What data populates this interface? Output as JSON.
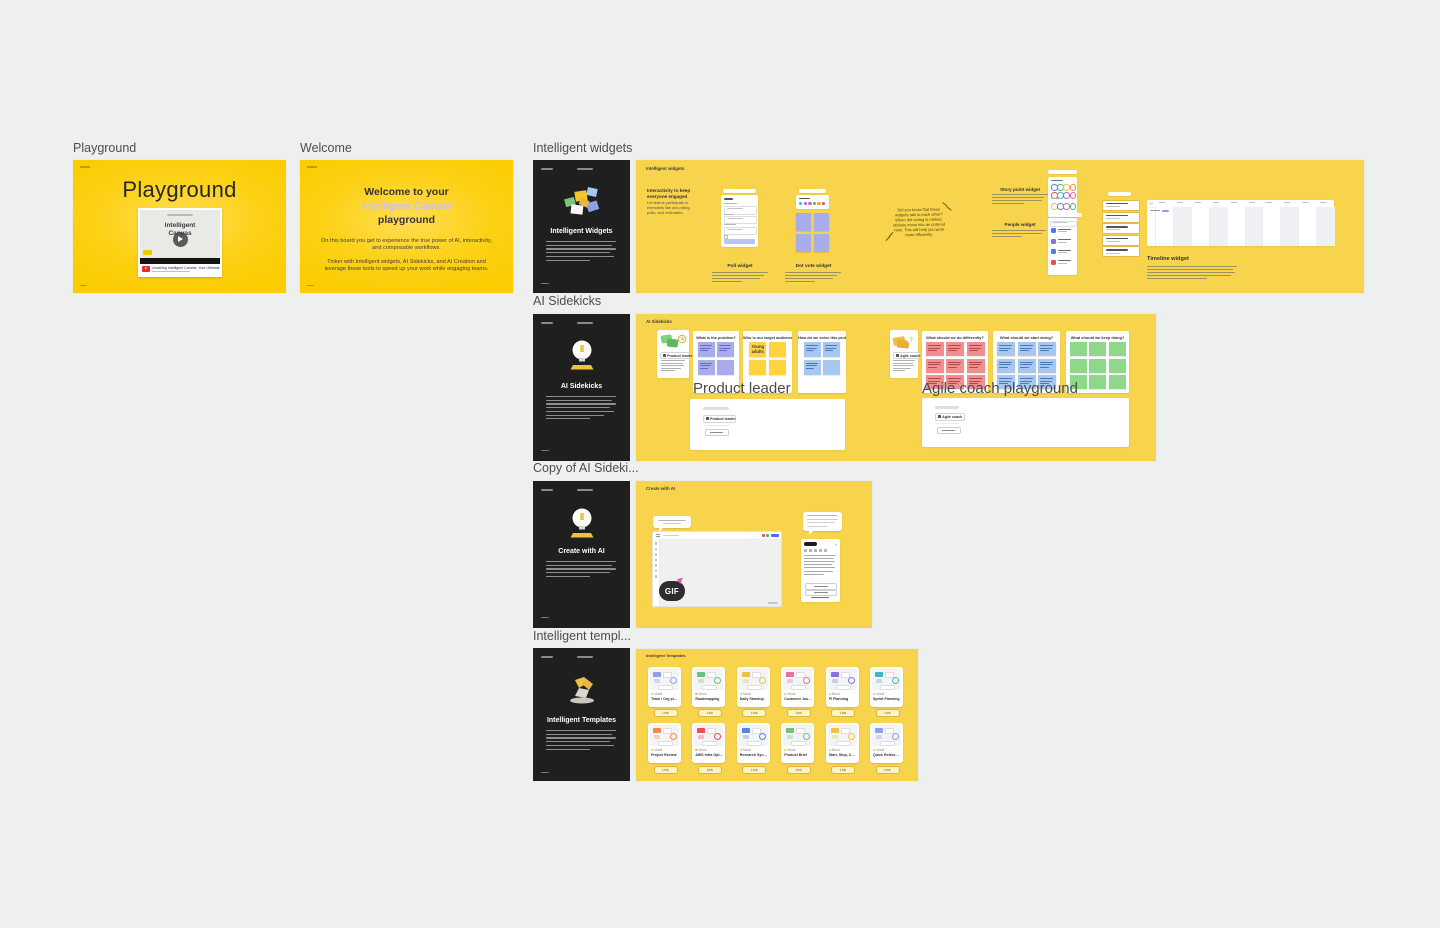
{
  "ui": {
    "background": "#edf0ef",
    "frame_yellow": "#fbcc00",
    "frame_soft_yellow": "#f8d44c",
    "dark_card_bg": "#1f1f1f",
    "poll_button_blue": "#b9c4f0",
    "sticky_purple": "#a9aceb",
    "sticky_yellow": "#ffd43e",
    "sticky_blue": "#a6c8f0",
    "sticky_red": "#ef8f8f",
    "sticky_green": "#8fd88a"
  },
  "section_labels": {
    "playground": "Playground",
    "welcome": "Welcome",
    "widgets": "Intelligent widgets",
    "sidekicks": "AI Sidekicks",
    "copy_sidekicks": "Copy of AI Sideki...",
    "templates": "Intelligent templ..."
  },
  "playground_frame": {
    "title": "Playground",
    "video_title_line1": "Intelligent",
    "video_title_line2": "Canvas",
    "video_caption": "Unveiling Intelligent Canvas: Your Ultimate Pow..."
  },
  "welcome_frame": {
    "heading_line1": "Welcome to your",
    "heading_line2": "Intelligent Canvas",
    "heading_line3": "playground",
    "para1": "On this board you get to experience the true power of AI, interactivity, and composable workflows.",
    "para2": "Tinker with Intelligent widgets, AI Sidekicks, and AI Creation and leverage these tools to speed up your work while engaging teams."
  },
  "widgets_dark_card": {
    "title": "Intelligent Widgets"
  },
  "sidekicks_dark_card": {
    "title": "AI Sidekicks"
  },
  "create_dark_card": {
    "title": "Create with AI"
  },
  "templates_dark_card": {
    "title": "Intelligent Templates"
  },
  "widgets_frame": {
    "label": "Intelligent widgets",
    "headline": "Interactivity to keep everyone engaged",
    "body": "Let teams participate in exercises like dot voting, polls, and estimates.",
    "poll_label": "Poll widget",
    "dot_vote_label": "Dot vote widget",
    "note": "Did you know that these widgets talk to each other? When dot voting is ranked, stickies move into an ordered rank. This will help you work more efficiently.",
    "story_point_label": "Story point widget",
    "people_label": "People widget",
    "timeline_label": "Timeline widget",
    "dot_colors": [
      "#45b5c4",
      "#8f6fd8",
      "#e8609e",
      "#58b85c",
      "#f0a43c",
      "#e05252"
    ],
    "story_dot_rows": [
      [
        "#4f86e8",
        "#4fb86a",
        "#f0c040",
        "#f08a3c"
      ],
      [
        "#e05252",
        "#45b5c4",
        "#8f6fd8",
        "#e8609e"
      ],
      [
        "#f0c040",
        "#4f86e8",
        "#e8609e",
        "#4fb86a"
      ]
    ],
    "people_avatar_colors": [
      "#4a7fd4",
      "#8f6fd8",
      "#4a7fd4",
      "#e05252"
    ]
  },
  "sidekicks_frame": {
    "label": "AI Sidekicks",
    "product_leader_tag": "Product leader",
    "agile_coach_tag": "Agile coach",
    "overlay_product": "Product leader",
    "overlay_agile": "Agile coach playground",
    "panels": [
      {
        "question": "What is the problem?",
        "color": "#a9aceb",
        "line_color": "#646ac8",
        "cols": 2,
        "rows": 2,
        "cells": [
          "lines",
          "lines",
          "lines",
          "blank"
        ]
      },
      {
        "question": "Who is our target audience",
        "color": "#ffd43e",
        "line_color": "#b08a10",
        "cols": 2,
        "rows": 2,
        "cells": [
          "text:Young adults",
          "blank",
          "blank",
          "blank"
        ]
      },
      {
        "question": "How do we solve this problem?",
        "color": "#a6c8f0",
        "line_color": "#4a7ab8",
        "cols": 2,
        "rows": 2,
        "cells": [
          "lines",
          "lines",
          "lines",
          "blank"
        ]
      },
      {
        "question": "What should we do differently?",
        "color": "#ef8f8f",
        "line_color": "#b84848",
        "cols": 3,
        "rows": 3,
        "cells": [
          "lines",
          "lines",
          "lines",
          "lines",
          "lines",
          "lines",
          "lines",
          "lines",
          "lines"
        ]
      },
      {
        "question": "What should we start doing?",
        "color": "#a6c8f0",
        "line_color": "#4a7ab8",
        "cols": 3,
        "rows": 3,
        "cells": [
          "lines",
          "lines",
          "lines",
          "lines",
          "lines",
          "lines",
          "lines",
          "lines",
          "lines"
        ]
      },
      {
        "question": "What should we keep doing?",
        "color": "#8fd88a",
        "line_color": "#4a9a4a",
        "cols": 3,
        "rows": 3,
        "cells": [
          "blank",
          "blank",
          "blank",
          "blank",
          "blank",
          "blank",
          "blank",
          "blank",
          "blank"
        ]
      }
    ]
  },
  "create_frame": {
    "label": "Create with AI",
    "gif_badge": "GIF"
  },
  "templates_frame": {
    "label": "Intelligent Templates",
    "card_badge": "Mural",
    "card_button": "Link",
    "card_titles": [
      "Team / Org planning",
      "Roadmapping",
      "Daily Standup",
      "Customer Journey Mapping",
      "PI Planning",
      "Sprint Planning",
      "Project Review",
      "AWS Infra Optimization",
      "Research Synthesis",
      "Product Brief",
      "Start, Stop, Continue Retro",
      "Quick Retrospective"
    ],
    "card_accents": [
      "#8f9fe8",
      "#6fc47c",
      "#f0c040",
      "#e86f9e",
      "#8f6fd8",
      "#45b5c4",
      "#f08a4c",
      "#e85252",
      "#4f86e8",
      "#6fc47c",
      "#f0c040",
      "#8f9fe8"
    ]
  }
}
